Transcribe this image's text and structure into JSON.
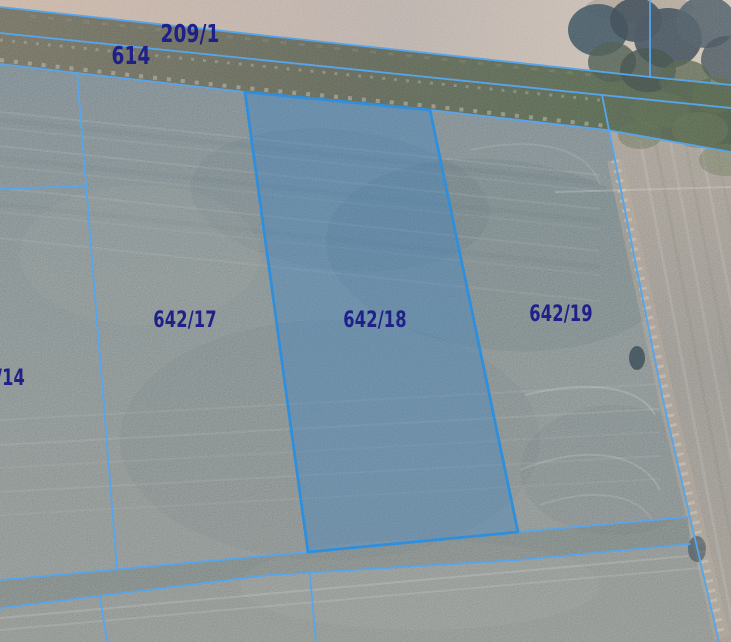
{
  "map": {
    "selected_parcel": "642/18",
    "labels": [
      {
        "id": "parcel-209-1",
        "text": "209/1"
      },
      {
        "id": "parcel-614",
        "text": "614"
      },
      {
        "id": "parcel-642-17",
        "text": "642/17"
      },
      {
        "id": "parcel-642-18",
        "text": "642/18"
      },
      {
        "id": "parcel-642-19",
        "text": "642/19"
      },
      {
        "id": "parcel-14-partial",
        "text": "/14"
      },
      {
        "id": "parcel-3-partial",
        "text": "3"
      }
    ],
    "colors": {
      "boundary_line": "#57a5ec",
      "selected_outline": "#2f8fdc",
      "selected_fill": "rgba(50,130,205,0.33)",
      "label_text": "#1f2089"
    }
  }
}
